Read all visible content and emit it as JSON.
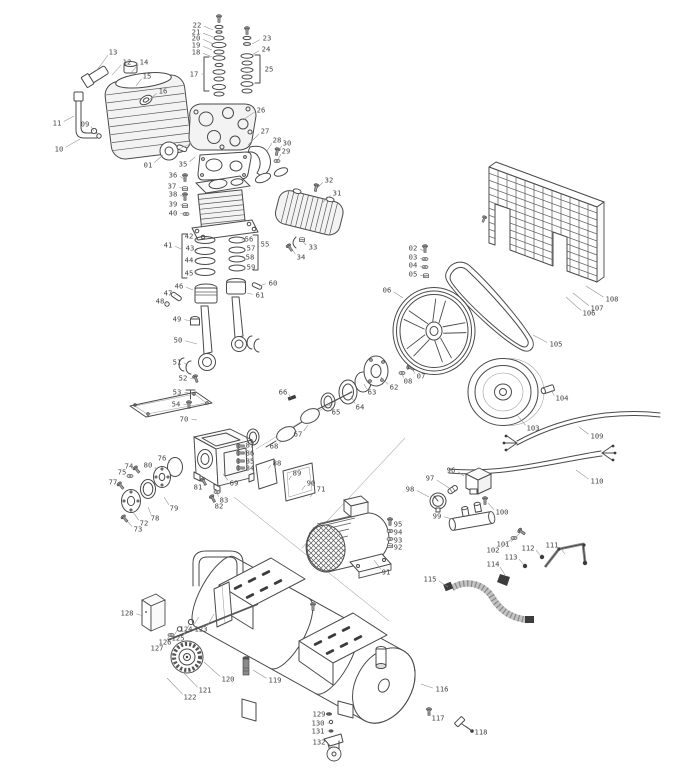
{
  "diagram": {
    "canvas": {
      "width": 686,
      "height": 768,
      "background": "#ffffff",
      "line_color": "#4a4a4a",
      "label_color": "#454545"
    },
    "labels": [
      {
        "n": "01",
        "x": 148,
        "y": 165,
        "px": 163,
        "py": 155
      },
      {
        "n": "02",
        "x": 413,
        "y": 248,
        "px": 424,
        "py": 251
      },
      {
        "n": "03",
        "x": 413,
        "y": 257,
        "px": 424,
        "py": 260
      },
      {
        "n": "04",
        "x": 413,
        "y": 265,
        "px": 424,
        "py": 268
      },
      {
        "n": "05",
        "x": 413,
        "y": 274,
        "px": 426,
        "py": 277
      },
      {
        "n": "06",
        "x": 387,
        "y": 290,
        "px": 403,
        "py": 298
      },
      {
        "n": "07",
        "x": 421,
        "y": 376,
        "px": 412,
        "py": 369
      },
      {
        "n": "08",
        "x": 408,
        "y": 381,
        "px": 402,
        "py": 373
      },
      {
        "n": "09",
        "x": 85,
        "y": 124,
        "px": 94,
        "py": 131
      },
      {
        "n": "10",
        "x": 59,
        "y": 149,
        "px": 80,
        "py": 139
      },
      {
        "n": "11",
        "x": 57,
        "y": 123,
        "px": 74,
        "py": 116
      },
      {
        "n": "12",
        "x": 127,
        "y": 62,
        "px": 112,
        "py": 75
      },
      {
        "n": "13",
        "x": 113,
        "y": 52,
        "px": 97,
        "py": 70
      },
      {
        "n": "14",
        "x": 144,
        "y": 62,
        "px": 130,
        "py": 74
      },
      {
        "n": "15",
        "x": 147,
        "y": 76,
        "px": 136,
        "py": 86
      },
      {
        "n": "16",
        "x": 163,
        "y": 91,
        "px": 149,
        "py": 100
      },
      {
        "n": "17",
        "x": 194,
        "y": 74,
        "px": 203,
        "py": 74
      },
      {
        "n": "18",
        "x": 196,
        "y": 52,
        "px": 212,
        "py": 57
      },
      {
        "n": "19",
        "x": 196,
        "y": 45,
        "px": 212,
        "py": 50
      },
      {
        "n": "20",
        "x": 196,
        "y": 38,
        "px": 213,
        "py": 44
      },
      {
        "n": "21",
        "x": 196,
        "y": 32,
        "px": 213,
        "py": 37
      },
      {
        "n": "22",
        "x": 197,
        "y": 25,
        "px": 213,
        "py": 30
      },
      {
        "n": "23",
        "x": 267,
        "y": 38,
        "px": 252,
        "py": 44
      },
      {
        "n": "24",
        "x": 266,
        "y": 49,
        "px": 252,
        "py": 55
      },
      {
        "n": "25",
        "x": 269,
        "y": 69,
        "px": 262,
        "py": 69
      },
      {
        "n": "26",
        "x": 261,
        "y": 110,
        "px": 243,
        "py": 120
      },
      {
        "n": "27",
        "x": 265,
        "y": 131,
        "px": 248,
        "py": 145
      },
      {
        "n": "28",
        "x": 277,
        "y": 140,
        "px": 267,
        "py": 151
      },
      {
        "n": "29",
        "x": 286,
        "y": 151,
        "px": 277,
        "py": 161
      },
      {
        "n": "30",
        "x": 287,
        "y": 143,
        "px": 277,
        "py": 153
      },
      {
        "n": "31",
        "x": 337,
        "y": 193,
        "px": 323,
        "py": 202
      },
      {
        "n": "32",
        "x": 329,
        "y": 180,
        "px": 316,
        "py": 189
      },
      {
        "n": "33",
        "x": 313,
        "y": 247,
        "px": 302,
        "py": 241
      },
      {
        "n": "34",
        "x": 301,
        "y": 257,
        "px": 291,
        "py": 248
      },
      {
        "n": "35",
        "x": 183,
        "y": 164,
        "px": 195,
        "py": 157
      },
      {
        "n": "36",
        "x": 173,
        "y": 175,
        "px": 184,
        "py": 179
      },
      {
        "n": "37",
        "x": 172,
        "y": 186,
        "px": 184,
        "py": 189
      },
      {
        "n": "38",
        "x": 173,
        "y": 194,
        "px": 184,
        "py": 197
      },
      {
        "n": "39",
        "x": 173,
        "y": 204,
        "px": 184,
        "py": 206
      },
      {
        "n": "40",
        "x": 173,
        "y": 213,
        "px": 185,
        "py": 214
      },
      {
        "n": "41",
        "x": 168,
        "y": 245,
        "px": 181,
        "py": 249
      },
      {
        "n": "42",
        "x": 189,
        "y": 236,
        "px": 197,
        "py": 240
      },
      {
        "n": "43",
        "x": 190,
        "y": 248,
        "px": 197,
        "py": 251
      },
      {
        "n": "44",
        "x": 189,
        "y": 260,
        "px": 197,
        "py": 261
      },
      {
        "n": "45",
        "x": 189,
        "y": 273,
        "px": 197,
        "py": 272
      },
      {
        "n": "46",
        "x": 179,
        "y": 286,
        "px": 193,
        "py": 290
      },
      {
        "n": "47",
        "x": 168,
        "y": 293,
        "px": 175,
        "py": 296
      },
      {
        "n": "48",
        "x": 160,
        "y": 301,
        "px": 167,
        "py": 304
      },
      {
        "n": "49",
        "x": 177,
        "y": 319,
        "px": 191,
        "py": 321
      },
      {
        "n": "50",
        "x": 178,
        "y": 340,
        "px": 197,
        "py": 344
      },
      {
        "n": "51",
        "x": 177,
        "y": 362,
        "px": 186,
        "py": 364
      },
      {
        "n": "52",
        "x": 183,
        "y": 378,
        "px": 194,
        "py": 379
      },
      {
        "n": "53",
        "x": 177,
        "y": 392,
        "px": 189,
        "py": 393
      },
      {
        "n": "54",
        "x": 176,
        "y": 404,
        "px": 188,
        "py": 405
      },
      {
        "n": "55",
        "x": 265,
        "y": 244,
        "px": 259,
        "py": 247
      },
      {
        "n": "56",
        "x": 249,
        "y": 239,
        "px": 244,
        "py": 240
      },
      {
        "n": "57",
        "x": 251,
        "y": 248,
        "px": 245,
        "py": 250
      },
      {
        "n": "58",
        "x": 250,
        "y": 257,
        "px": 245,
        "py": 258
      },
      {
        "n": "59",
        "x": 251,
        "y": 267,
        "px": 245,
        "py": 267
      },
      {
        "n": "60",
        "x": 273,
        "y": 283,
        "px": 259,
        "py": 286
      },
      {
        "n": "61",
        "x": 260,
        "y": 295,
        "px": 247,
        "py": 293
      },
      {
        "n": "62",
        "x": 394,
        "y": 387,
        "px": 381,
        "py": 377
      },
      {
        "n": "63",
        "x": 372,
        "y": 392,
        "px": 364,
        "py": 384
      },
      {
        "n": "64",
        "x": 360,
        "y": 407,
        "px": 351,
        "py": 396
      },
      {
        "n": "65",
        "x": 336,
        "y": 412,
        "px": 329,
        "py": 403
      },
      {
        "n": "66",
        "x": 283,
        "y": 392,
        "px": 291,
        "py": 398
      },
      {
        "n": "67",
        "x": 298,
        "y": 434,
        "px": 308,
        "py": 425
      },
      {
        "n": "68",
        "x": 274,
        "y": 446,
        "px": 281,
        "py": 440
      },
      {
        "n": "69",
        "x": 234,
        "y": 483,
        "px": 223,
        "py": 474
      },
      {
        "n": "70",
        "x": 184,
        "y": 419,
        "px": 197,
        "py": 420
      },
      {
        "n": "71",
        "x": 321,
        "y": 489,
        "px": 310,
        "py": 497
      },
      {
        "n": "72",
        "x": 144,
        "y": 523,
        "px": 133,
        "py": 512
      },
      {
        "n": "73",
        "x": 138,
        "y": 529,
        "px": 126,
        "py": 520
      },
      {
        "n": "74",
        "x": 129,
        "y": 466,
        "px": 137,
        "py": 470
      },
      {
        "n": "75",
        "x": 122,
        "y": 472,
        "px": 130,
        "py": 476
      },
      {
        "n": "76",
        "x": 162,
        "y": 458,
        "px": 170,
        "py": 463
      },
      {
        "n": "77",
        "x": 113,
        "y": 482,
        "px": 121,
        "py": 485
      },
      {
        "n": "78",
        "x": 155,
        "y": 518,
        "px": 148,
        "py": 507
      },
      {
        "n": "79",
        "x": 174,
        "y": 508,
        "px": 164,
        "py": 497
      },
      {
        "n": "80",
        "x": 148,
        "y": 465,
        "px": 156,
        "py": 469
      },
      {
        "n": "81",
        "x": 198,
        "y": 487,
        "px": 204,
        "py": 482
      },
      {
        "n": "82",
        "x": 219,
        "y": 506,
        "px": 213,
        "py": 499
      },
      {
        "n": "83",
        "x": 224,
        "y": 500,
        "px": 217,
        "py": 493
      },
      {
        "n": "84",
        "x": 250,
        "y": 468,
        "px": 244,
        "py": 467
      },
      {
        "n": "85",
        "x": 250,
        "y": 461,
        "px": 244,
        "py": 460
      },
      {
        "n": "86",
        "x": 250,
        "y": 453,
        "px": 244,
        "py": 453
      },
      {
        "n": "87",
        "x": 250,
        "y": 445,
        "px": 244,
        "py": 445
      },
      {
        "n": "88",
        "x": 277,
        "y": 463,
        "px": 268,
        "py": 469
      },
      {
        "n": "89",
        "x": 297,
        "y": 473,
        "px": 289,
        "py": 480
      },
      {
        "n": "90",
        "x": 311,
        "y": 483,
        "px": 302,
        "py": 490
      },
      {
        "n": "91",
        "x": 386,
        "y": 572,
        "px": 374,
        "py": 560
      },
      {
        "n": "92",
        "x": 398,
        "y": 547,
        "px": 392,
        "py": 546
      },
      {
        "n": "93",
        "x": 398,
        "y": 540,
        "px": 392,
        "py": 539
      },
      {
        "n": "94",
        "x": 398,
        "y": 532,
        "px": 392,
        "py": 531
      },
      {
        "n": "95",
        "x": 398,
        "y": 524,
        "px": 392,
        "py": 523
      },
      {
        "n": "96",
        "x": 451,
        "y": 470,
        "px": 464,
        "py": 476
      },
      {
        "n": "97",
        "x": 430,
        "y": 478,
        "px": 449,
        "py": 488
      },
      {
        "n": "98",
        "x": 410,
        "y": 489,
        "px": 429,
        "py": 497
      },
      {
        "n": "99",
        "x": 437,
        "y": 516,
        "px": 452,
        "py": 519
      },
      {
        "n": "100",
        "x": 502,
        "y": 512,
        "px": 488,
        "py": 503
      },
      {
        "n": "101",
        "x": 503,
        "y": 544,
        "px": 520,
        "py": 533
      },
      {
        "n": "102",
        "x": 493,
        "y": 550,
        "px": 513,
        "py": 538
      },
      {
        "n": "103",
        "x": 533,
        "y": 428,
        "px": 517,
        "py": 415
      },
      {
        "n": "104",
        "x": 562,
        "y": 398,
        "px": 551,
        "py": 390
      },
      {
        "n": "105",
        "x": 556,
        "y": 344,
        "px": 533,
        "py": 335
      },
      {
        "n": "106",
        "x": 589,
        "y": 313,
        "px": 566,
        "py": 297
      },
      {
        "n": "107",
        "x": 597,
        "y": 308,
        "px": 573,
        "py": 293
      },
      {
        "n": "108",
        "x": 612,
        "y": 299,
        "px": 586,
        "py": 286
      },
      {
        "n": "109",
        "x": 597,
        "y": 436,
        "px": 579,
        "py": 427
      },
      {
        "n": "110",
        "x": 597,
        "y": 481,
        "px": 576,
        "py": 470
      },
      {
        "n": "111",
        "x": 552,
        "y": 545,
        "px": 565,
        "py": 554
      },
      {
        "n": "112",
        "x": 528,
        "y": 548,
        "px": 541,
        "py": 556
      },
      {
        "n": "113",
        "x": 511,
        "y": 557,
        "px": 524,
        "py": 565
      },
      {
        "n": "114",
        "x": 493,
        "y": 564,
        "px": 505,
        "py": 575
      },
      {
        "n": "115",
        "x": 430,
        "y": 579,
        "px": 448,
        "py": 587
      },
      {
        "n": "116",
        "x": 442,
        "y": 689,
        "px": 421,
        "py": 684
      },
      {
        "n": "117",
        "x": 438,
        "y": 718,
        "px": 429,
        "py": 713
      },
      {
        "n": "118",
        "x": 481,
        "y": 732,
        "px": 466,
        "py": 726
      },
      {
        "n": "119",
        "x": 275,
        "y": 680,
        "px": 253,
        "py": 670
      },
      {
        "n": "120",
        "x": 228,
        "y": 679,
        "px": 204,
        "py": 662
      },
      {
        "n": "121",
        "x": 205,
        "y": 690,
        "px": 183,
        "py": 672
      },
      {
        "n": "122",
        "x": 190,
        "y": 697,
        "px": 167,
        "py": 678
      },
      {
        "n": "123",
        "x": 201,
        "y": 629,
        "px": 214,
        "py": 614
      },
      {
        "n": "124",
        "x": 186,
        "y": 629,
        "px": 199,
        "py": 617
      },
      {
        "n": "125",
        "x": 178,
        "y": 638,
        "px": 190,
        "py": 623
      },
      {
        "n": "126",
        "x": 165,
        "y": 642,
        "px": 178,
        "py": 629
      },
      {
        "n": "127",
        "x": 157,
        "y": 648,
        "px": 170,
        "py": 635
      },
      {
        "n": "128",
        "x": 127,
        "y": 613,
        "px": 143,
        "py": 616
      },
      {
        "n": "129",
        "x": 319,
        "y": 714,
        "px": 329,
        "py": 715
      },
      {
        "n": "130",
        "x": 318,
        "y": 723,
        "px": 330,
        "py": 723
      },
      {
        "n": "131",
        "x": 318,
        "y": 731,
        "px": 330,
        "py": 731
      },
      {
        "n": "132",
        "x": 319,
        "y": 742,
        "px": 328,
        "py": 745
      }
    ]
  }
}
